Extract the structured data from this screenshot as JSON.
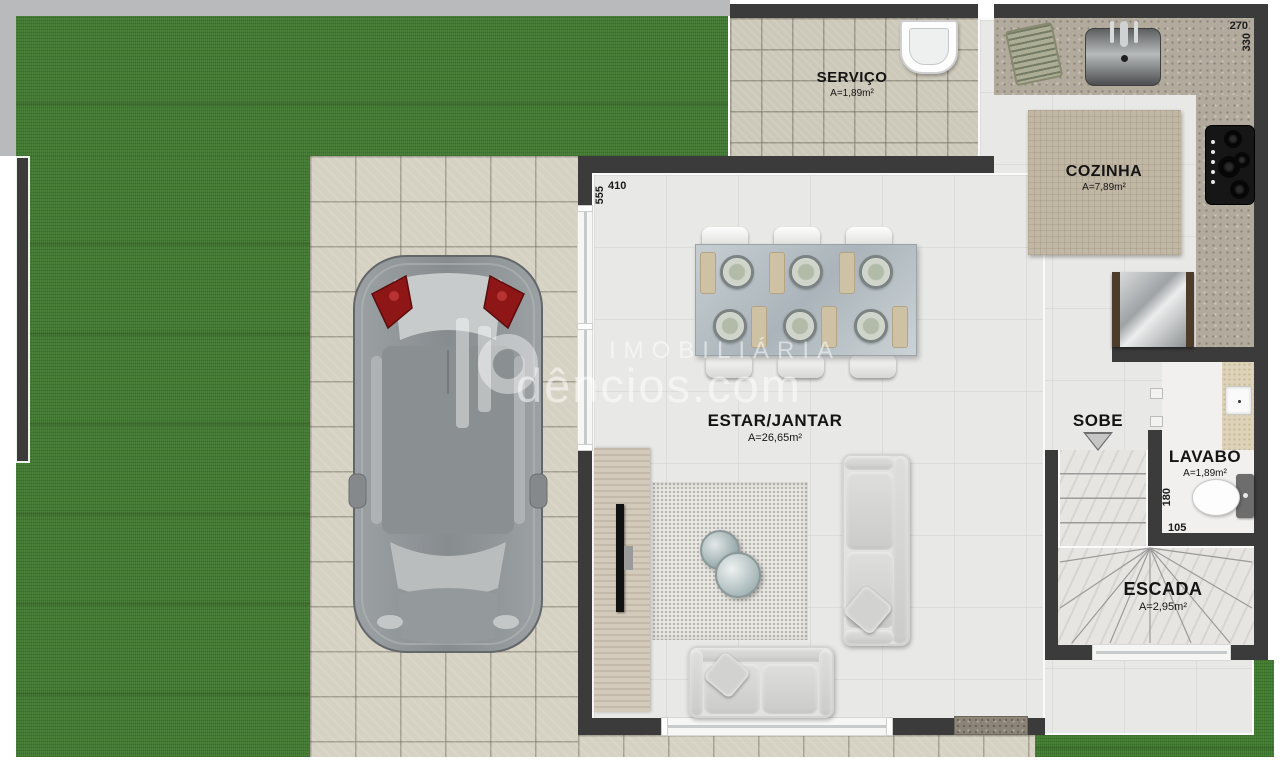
{
  "watermark": {
    "line1": "IMOBILIÁRIA",
    "line2": "dêncios.com"
  },
  "rooms": {
    "servico": {
      "name": "SERVIÇO",
      "area": "A=1,89m²"
    },
    "cozinha": {
      "name": "COZINHA",
      "area": "A=7,89m²"
    },
    "estar_jantar": {
      "name": "ESTAR/JANTAR",
      "area": "A=26,65m²"
    },
    "lavabo": {
      "name": "LAVABO",
      "area": "A=1,89m²"
    },
    "escada": {
      "name": "ESCADA",
      "area": "A=2,95m²"
    }
  },
  "labels": {
    "sobe": "SOBE"
  },
  "dimensions": {
    "cozinha_width": "270",
    "cozinha_depth": "330",
    "estar_width": "410",
    "estar_depth": "555",
    "lavabo_depth": "180",
    "lavabo_width": "105"
  },
  "colors": {
    "grass": "#407a2f",
    "sidewalk": "#b8babc",
    "wall": "#3b3b3b",
    "paver_tile": "#d6d2c3",
    "interior_floor": "#e8e8e6",
    "taillight_red": "#8e1616"
  }
}
